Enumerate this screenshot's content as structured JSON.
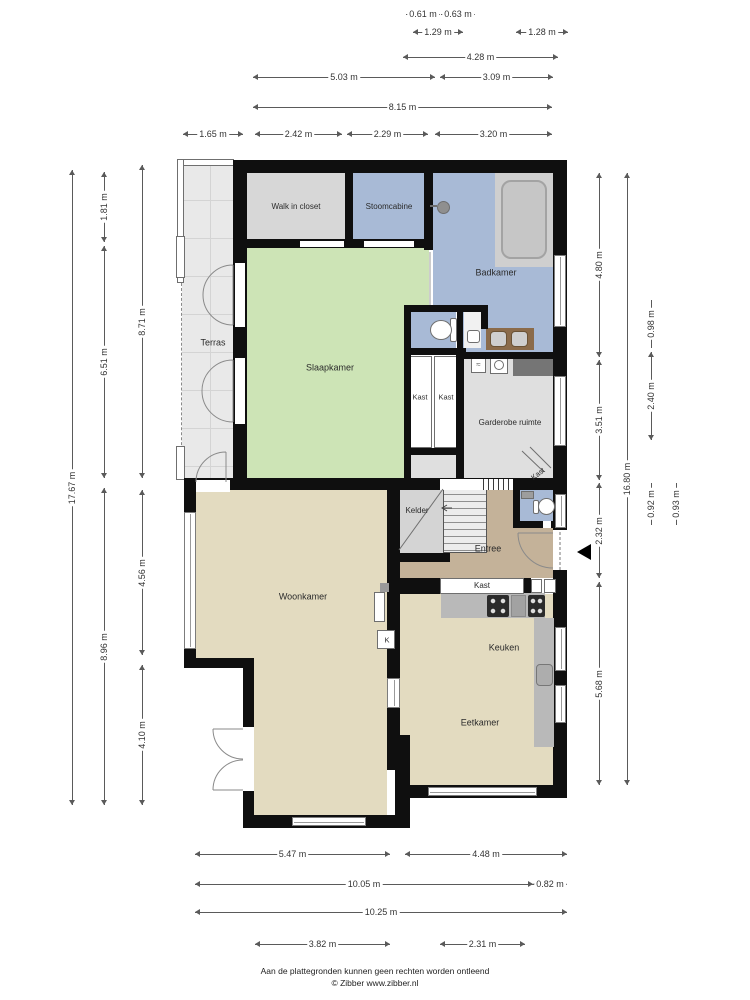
{
  "title": "Plattegrond begane grond",
  "rooms": {
    "terras": "Terras",
    "walk_in_closet": "Walk in closet",
    "stoomcabine": "Stoomcabine",
    "badkamer": "Badkamer",
    "slaapkamer": "Slaapkamer",
    "kast_a": "Kast",
    "kast_b": "Kast",
    "garderobe_ruimte": "Garderobe ruimte",
    "kast_trap": "Kast",
    "kelder": "Kelder",
    "entree": "Entree",
    "kast_hal": "Kast",
    "kast_k": "K",
    "woonkamer": "Woonkamer",
    "keuken": "Keuken",
    "eetkamer": "Eetkamer"
  },
  "dimension_lines": [
    {
      "t": "0.61 m",
      "o": "h",
      "x": 406,
      "y": 15,
      "l": 34,
      "a": false
    },
    {
      "t": "0.63 m",
      "o": "h",
      "x": 441,
      "y": 15,
      "l": 34,
      "a": false
    },
    {
      "t": "1.29 m",
      "o": "h",
      "x": 413,
      "y": 33,
      "l": 50,
      "a": true
    },
    {
      "t": "1.28 m",
      "o": "h",
      "x": 516,
      "y": 33,
      "l": 52,
      "a": true
    },
    {
      "t": "4.28 m",
      "o": "h",
      "x": 403,
      "y": 58,
      "l": 155,
      "a": true
    },
    {
      "t": "5.03 m",
      "o": "h",
      "x": 253,
      "y": 78,
      "l": 182,
      "a": true
    },
    {
      "t": "3.09 m",
      "o": "h",
      "x": 440,
      "y": 78,
      "l": 113,
      "a": true
    },
    {
      "t": "8.15 m",
      "o": "h",
      "x": 253,
      "y": 108,
      "l": 299,
      "a": true
    },
    {
      "t": "1.65 m",
      "o": "h",
      "x": 183,
      "y": 135,
      "l": 60,
      "a": true
    },
    {
      "t": "2.42 m",
      "o": "h",
      "x": 255,
      "y": 135,
      "l": 87,
      "a": true
    },
    {
      "t": "2.29 m",
      "o": "h",
      "x": 347,
      "y": 135,
      "l": 81,
      "a": true
    },
    {
      "t": "3.20 m",
      "o": "h",
      "x": 435,
      "y": 135,
      "l": 117,
      "a": true
    },
    {
      "t": "5.47 m",
      "o": "h",
      "x": 195,
      "y": 855,
      "l": 195,
      "a": true
    },
    {
      "t": "4.48 m",
      "o": "h",
      "x": 405,
      "y": 855,
      "l": 162,
      "a": true
    },
    {
      "t": "10.05 m",
      "o": "h",
      "x": 195,
      "y": 885,
      "l": 338,
      "a": true
    },
    {
      "t": "0.82 m",
      "o": "h",
      "x": 533,
      "y": 885,
      "l": 34,
      "a": true
    },
    {
      "t": "10.25 m",
      "o": "h",
      "x": 195,
      "y": 913,
      "l": 372,
      "a": true
    },
    {
      "t": "3.82 m",
      "o": "h",
      "x": 255,
      "y": 945,
      "l": 135,
      "a": true
    },
    {
      "t": "2.31 m",
      "o": "h",
      "x": 440,
      "y": 945,
      "l": 85,
      "a": true
    },
    {
      "t": "17.67 m",
      "o": "v",
      "x": 73,
      "y": 170,
      "l": 635,
      "a": true
    },
    {
      "t": "1.81 m",
      "o": "v",
      "x": 105,
      "y": 172,
      "l": 70,
      "a": true
    },
    {
      "t": "6.51 m",
      "o": "v",
      "x": 105,
      "y": 246,
      "l": 232,
      "a": true
    },
    {
      "t": "8.96 m",
      "o": "v",
      "x": 105,
      "y": 488,
      "l": 317,
      "a": true
    },
    {
      "t": "8.71 m",
      "o": "v",
      "x": 143,
      "y": 165,
      "l": 313,
      "a": true
    },
    {
      "t": "4.56 m",
      "o": "v",
      "x": 143,
      "y": 490,
      "l": 165,
      "a": true
    },
    {
      "t": "4.10 m",
      "o": "v",
      "x": 143,
      "y": 665,
      "l": 140,
      "a": true
    },
    {
      "t": "4.80 m",
      "o": "v",
      "x": 600,
      "y": 173,
      "l": 184,
      "a": true
    },
    {
      "t": "3.51 m",
      "o": "v",
      "x": 600,
      "y": 360,
      "l": 120,
      "a": true
    },
    {
      "t": "2.32 m",
      "o": "v",
      "x": 600,
      "y": 483,
      "l": 95,
      "a": true
    },
    {
      "t": "5.68 m",
      "o": "v",
      "x": 600,
      "y": 582,
      "l": 203,
      "a": true
    },
    {
      "t": "16.80 m",
      "o": "v",
      "x": 628,
      "y": 173,
      "l": 612,
      "a": true
    },
    {
      "t": "0.98 m",
      "o": "v",
      "x": 652,
      "y": 300,
      "l": 48,
      "a": false
    },
    {
      "t": "2.40 m",
      "o": "v",
      "x": 652,
      "y": 352,
      "l": 88,
      "a": true
    },
    {
      "t": "0.92 m",
      "o": "v",
      "x": 652,
      "y": 483,
      "l": 42,
      "a": false
    },
    {
      "t": "0.93 m",
      "o": "v",
      "x": 677,
      "y": 483,
      "l": 42,
      "a": false
    }
  ],
  "footer": {
    "disclaimer": "Aan de plattegronden kunnen geen rechten worden ontleend",
    "copyright": "© Zibber www.zibber.nl"
  },
  "colors": {
    "wall": "#0f0f0f",
    "blue": "#a8bad6",
    "green": "#cde4b6",
    "tan": "#e3dbc0",
    "entree_brown": "#c4b299",
    "gray_room": "#d7d7d7",
    "gray_light": "#e9e9e9",
    "garderobe": "#dfdfdf",
    "kelder": "#d4d4d4",
    "counter": "#b9b9b9",
    "counter_dark": "#757575",
    "vanity_brown": "#8b6b4a",
    "stove_dark": "#2b2b2b",
    "dim_text": "#333333"
  }
}
